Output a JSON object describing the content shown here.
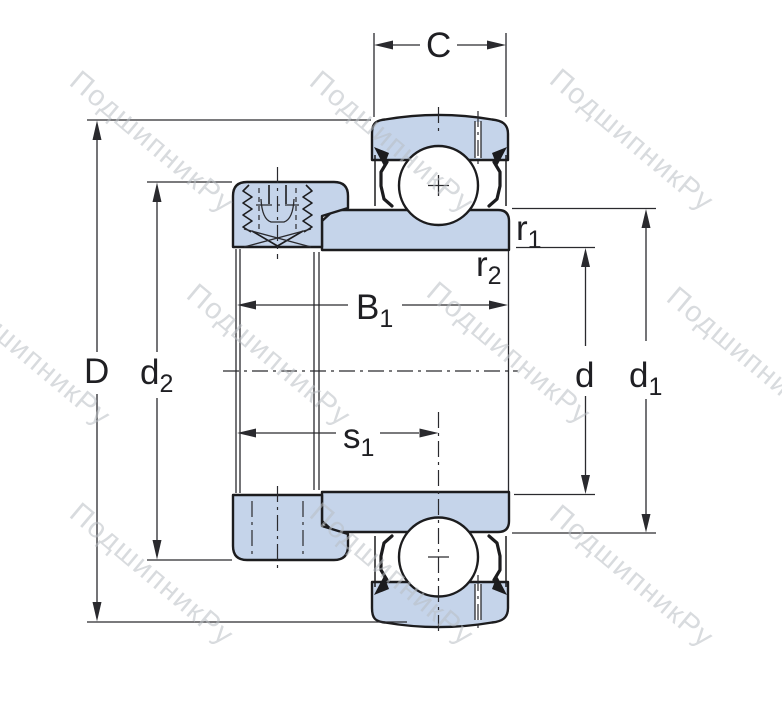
{
  "colors": {
    "background": "#ffffff",
    "part_fill": "#c5d4ea",
    "line": "#1c1c1e",
    "dim": "#2a2a2e",
    "text": "#1f1f23",
    "watermark": "#b9bdc3"
  },
  "watermark": {
    "text": "ПодшипникРу"
  },
  "dimensions": {
    "outer_ring_width": {
      "base": "C",
      "sub": ""
    },
    "outer_diameter": {
      "base": "D",
      "sub": ""
    },
    "collar_diameter": {
      "base": "d",
      "sub": "2"
    },
    "total_width": {
      "base": "B",
      "sub": "1"
    },
    "collar_offset": {
      "base": "s",
      "sub": "1"
    },
    "fillet_radius_1": {
      "base": "r",
      "sub": "1"
    },
    "fillet_radius_2": {
      "base": "r",
      "sub": "2"
    },
    "bore_diameter": {
      "base": "d",
      "sub": ""
    },
    "shoulder_diameter": {
      "base": "d",
      "sub": "1"
    }
  }
}
